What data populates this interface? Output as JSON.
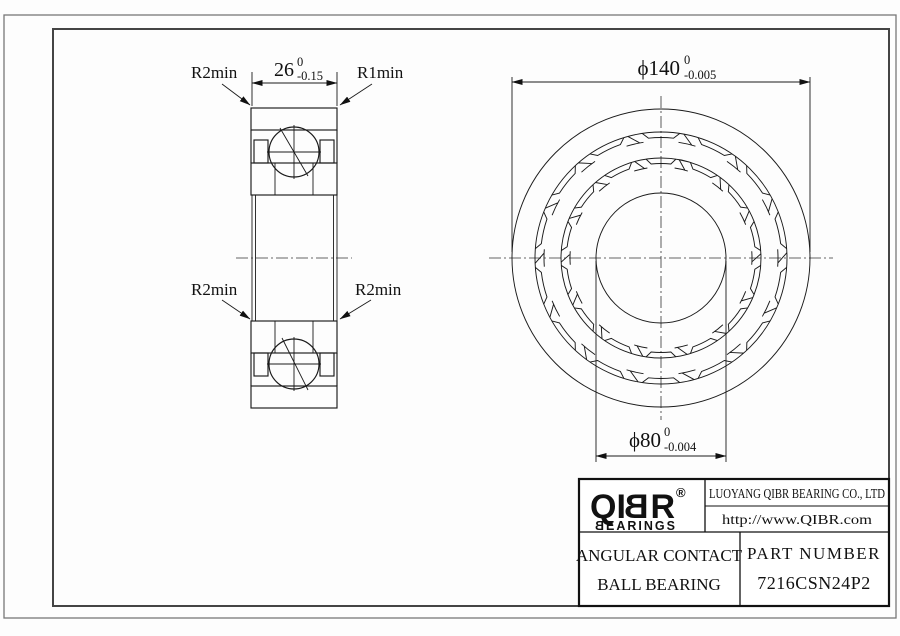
{
  "drawing": {
    "section_view": {
      "label_top_left": "R2min",
      "label_top_right": "R1min",
      "label_bottom_left": "R2min",
      "label_bottom_right": "R2min",
      "width_dim": {
        "value": "26",
        "tol_upper": "0",
        "tol_lower": "-0.15"
      }
    },
    "front_view": {
      "outer_diameter_dim": {
        "value": "ϕ140",
        "tol_upper": "0",
        "tol_lower": "-0.005"
      },
      "bore_diameter_dim": {
        "value": "ϕ80",
        "tol_upper": "0",
        "tol_lower": "-0.004"
      }
    }
  },
  "title_block": {
    "logo": {
      "prefix": "QI",
      "mirrored_letter": "B",
      "suffix": "R",
      "registered_mark": "®",
      "sub_mirrored_letter": "B",
      "sub_rest": "EARINGS"
    },
    "company_name": "LUOYANG QIBR BEARING CO., LTD",
    "website": "http://www.QIBR.com",
    "product_line1": "ANGULAR CONTACT",
    "product_line2": "BALL BEARING",
    "part_number_label": "PART NUMBER",
    "part_number_value": "7216CSN24P2"
  }
}
